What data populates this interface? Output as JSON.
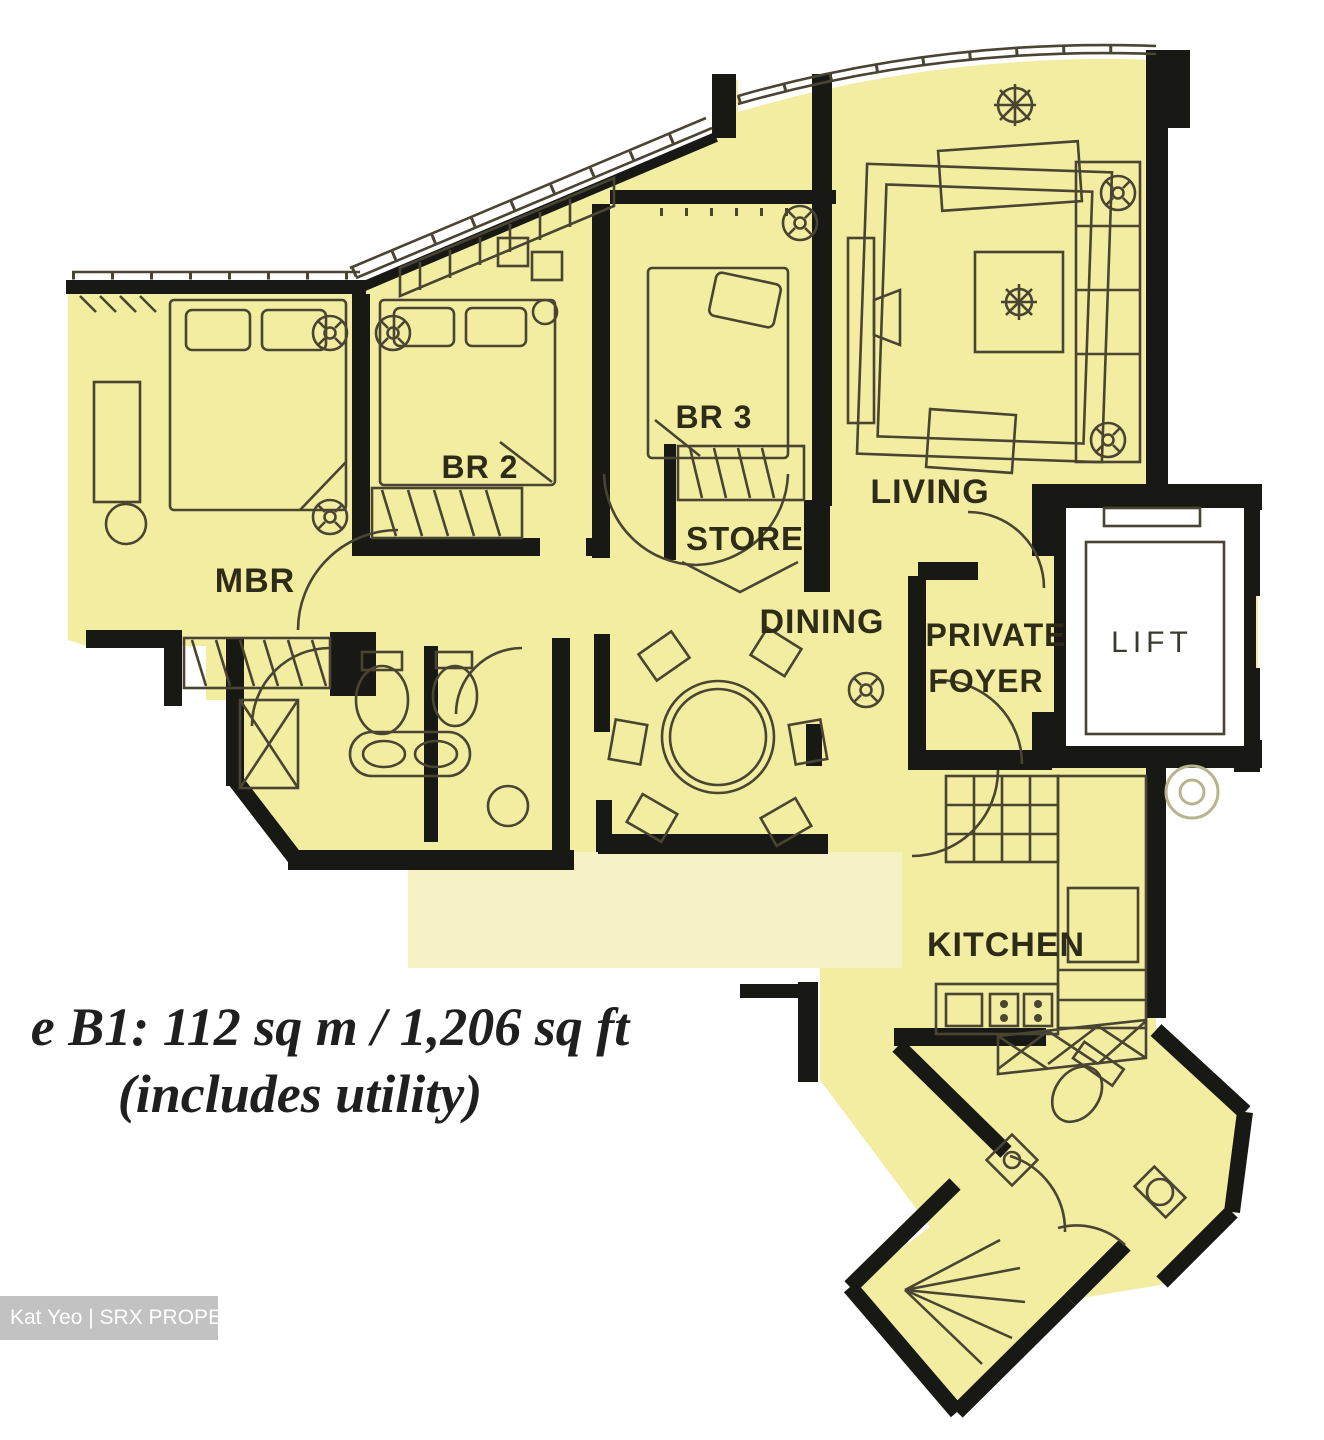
{
  "plan": {
    "rooms": {
      "mbr": "MBR",
      "br2": "BR 2",
      "br3": "BR 3",
      "store": "STORE",
      "living": "LIVING",
      "dining": "DINING",
      "private_foyer": {
        "line1": "PRIVATE",
        "line2": "FOYER"
      },
      "lift": "LIFT",
      "kitchen": "KITCHEN"
    },
    "icons": [
      "aircon-fan-icon",
      "plant-icon",
      "spiral-chute-icon"
    ]
  },
  "caption": {
    "line1": "e B1: 112 sq m / 1,206 sq ft",
    "line2": "(includes utility)"
  },
  "watermark": {
    "label": "Kat Yeo | SRX PROPERTY"
  },
  "colors": {
    "room_fill": "#f2eda1",
    "faded_fill": "#f6f2c6",
    "wall": "#181814",
    "line": "#4a4433",
    "label": "#2e2c18",
    "paper": "#ffffff",
    "watermark_bg": "#c2c2c2",
    "watermark_text": "#ffffff"
  }
}
